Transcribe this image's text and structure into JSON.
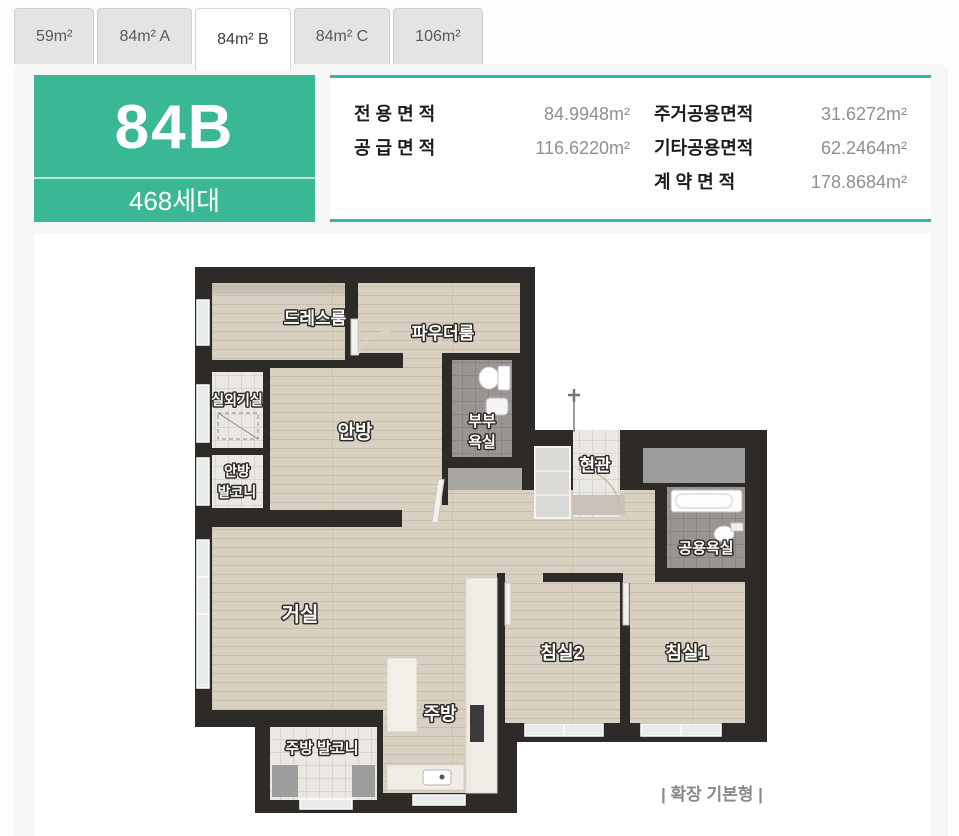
{
  "tabs": [
    {
      "label": "59m²",
      "active": false
    },
    {
      "label": "84m² A",
      "active": false
    },
    {
      "label": "84m² B",
      "active": true
    },
    {
      "label": "84m² C",
      "active": false
    },
    {
      "label": "106m²",
      "active": false
    }
  ],
  "unit": {
    "name": "84B",
    "households": "468세대"
  },
  "areas": {
    "left": [
      {
        "label": "전 용 면 적",
        "value": "84.9948m²"
      },
      {
        "label": "공 급 면 적",
        "value": "116.6220m²"
      }
    ],
    "right": [
      {
        "label": "주거공용면적",
        "value": "31.6272m²"
      },
      {
        "label": "기타공용면적",
        "value": "62.2464m²"
      },
      {
        "label": "계 약 면 적",
        "value": "178.8684m²"
      }
    ]
  },
  "floorplan": {
    "caption": "| 확장 기본형 |",
    "labels": {
      "dress": "드레스룸",
      "powder": "파우더룸",
      "outdoor": "실외기실",
      "master": "안방",
      "master_bath_1": "부부",
      "master_bath_2": "욕실",
      "master_balcony_1": "안방",
      "master_balcony_2": "발코니",
      "entry": "현관",
      "common_bath": "공용욕실",
      "living": "거실",
      "bed2": "침실2",
      "bed1": "침실1",
      "kitchen": "주방",
      "kitchen_balcony": "주방 발코니"
    }
  },
  "colors": {
    "accent_green": "#3ab795",
    "teal_border": "#35b79c",
    "wall": "#2d2a27",
    "wood_floor": "#d8d0c1",
    "bath_tile": "#9a9592"
  }
}
